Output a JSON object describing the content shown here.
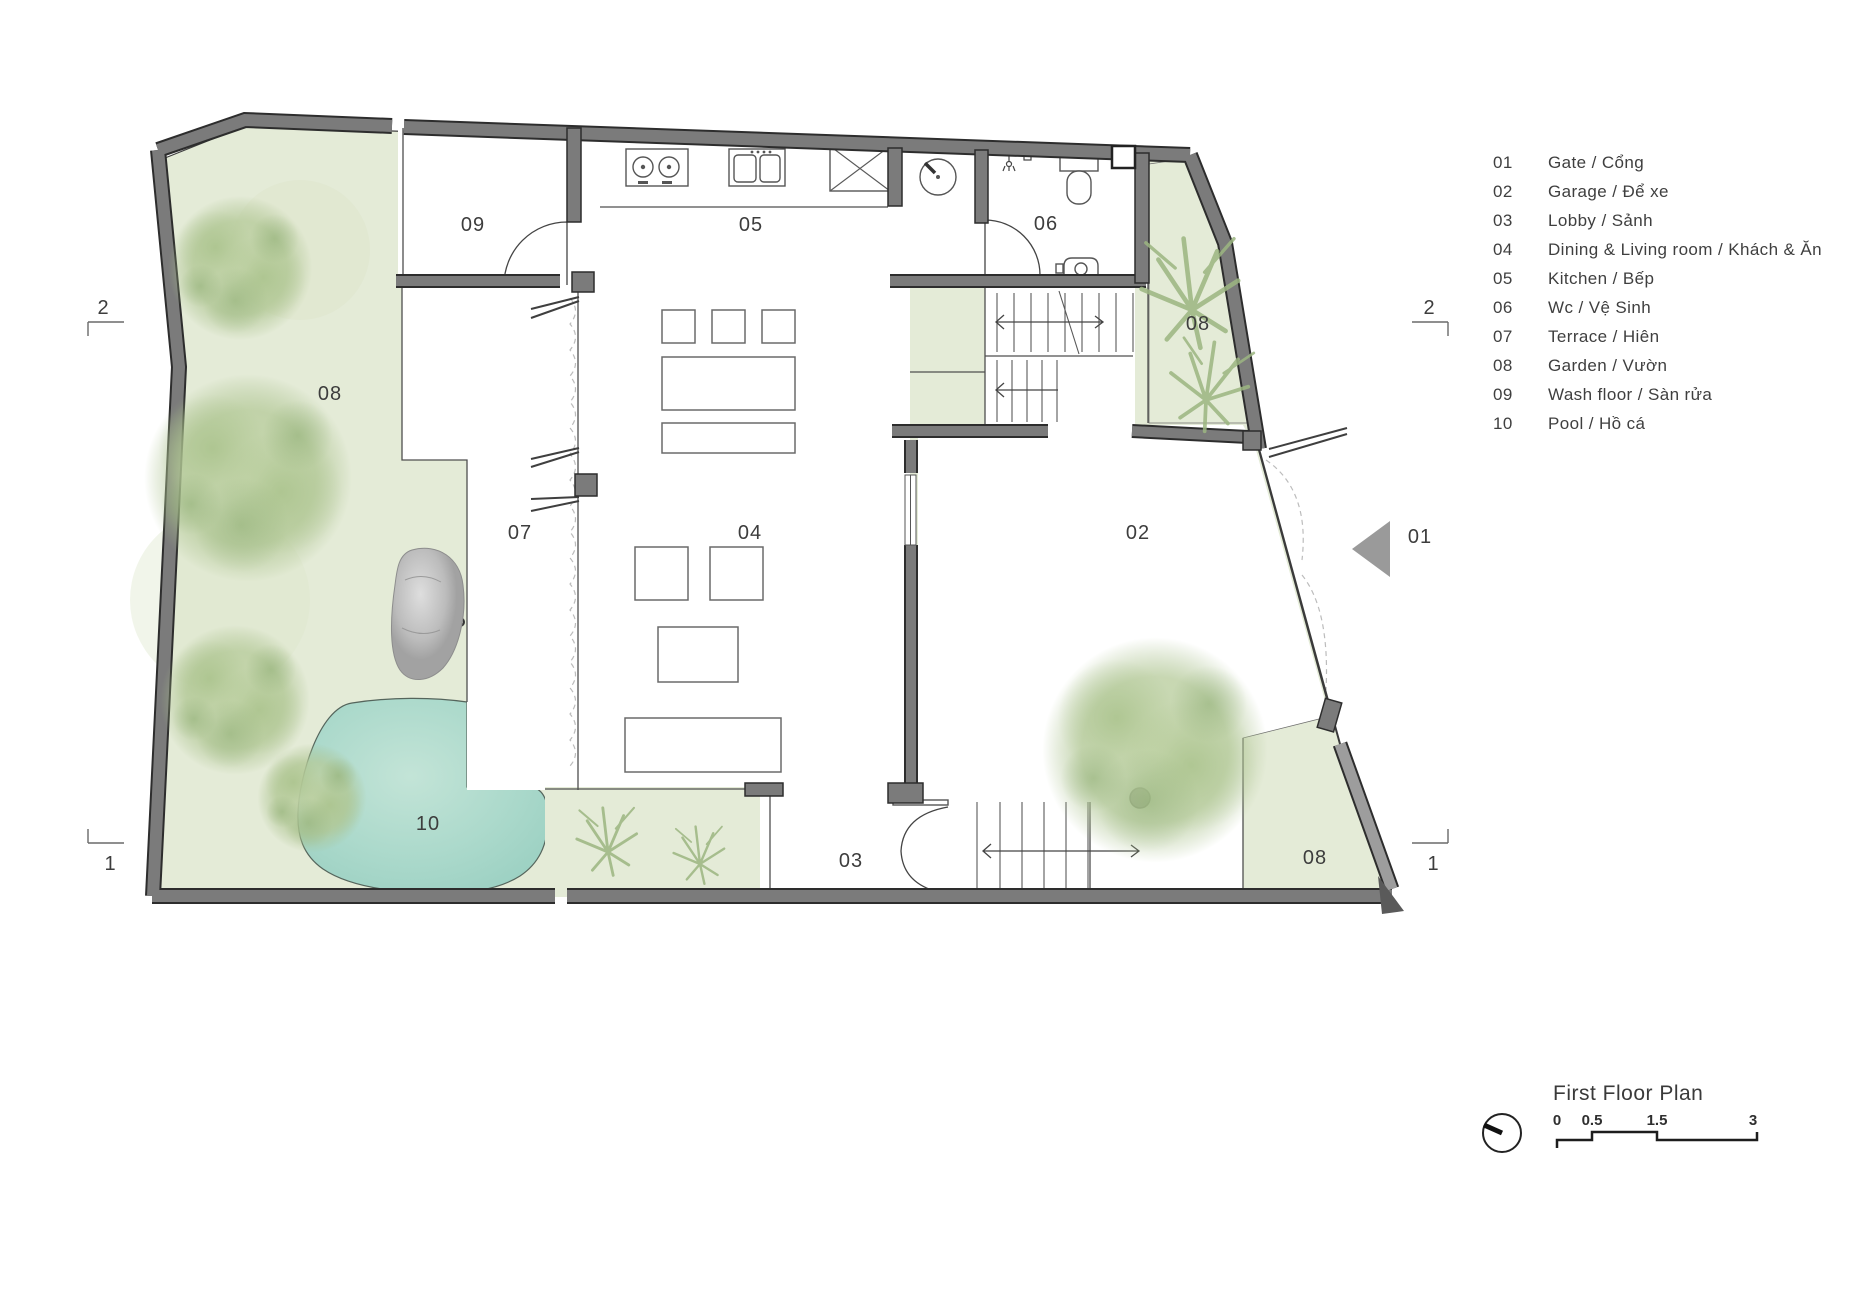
{
  "legend": {
    "items": [
      {
        "number": "01",
        "label": "Gate / Cổng"
      },
      {
        "number": "02",
        "label": "Garage / Để xe"
      },
      {
        "number": "03",
        "label": "Lobby / Sảnh"
      },
      {
        "number": "04",
        "label": "Dining & Living room / Khách & Ăn"
      },
      {
        "number": "05",
        "label": "Kitchen / Bếp"
      },
      {
        "number": "06",
        "label": "Wc / Vệ Sinh"
      },
      {
        "number": "07",
        "label": "Terrace / Hiên"
      },
      {
        "number": "08",
        "label": "Garden / Vườn"
      },
      {
        "number": "09",
        "label": "Wash floor / Sàn rửa"
      },
      {
        "number": "10",
        "label": "Pool / Hồ cá"
      }
    ]
  },
  "plan": {
    "labels": {
      "gate": "01",
      "garage": "02",
      "lobby": "03",
      "dining_living": "04",
      "kitchen": "05",
      "wc": "06",
      "terrace": "07",
      "garden_left": "08",
      "garden_top_right": "08",
      "garden_bottom_right": "08",
      "wash_floor": "09",
      "pool": "10"
    },
    "section_markers": {
      "top_left": "2",
      "top_right": "2",
      "bottom_left": "1",
      "bottom_right": "1"
    }
  },
  "title_block": {
    "title": "First Floor Plan",
    "scale_ticks": [
      "0",
      "0.5",
      "1.5",
      "3"
    ]
  },
  "colors": {
    "wall_gray": "#7b7b7b",
    "garden_green": "#e4ebd7",
    "pool_teal": "#a9d8cb",
    "tree_green": "#b7cb9c",
    "text": "#3f3f3f"
  }
}
